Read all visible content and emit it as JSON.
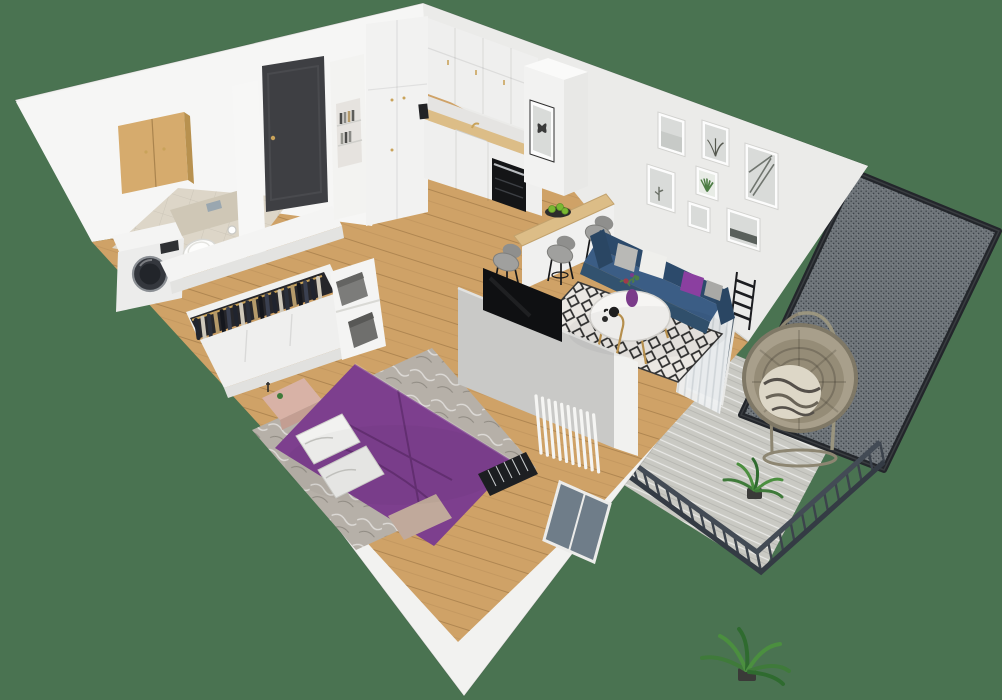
{
  "scene": {
    "kind": "isometric-apartment-render",
    "background_color": "#4a7351"
  },
  "palette": {
    "background": "#4a7351",
    "wall": "#f2f2f0",
    "wall_bright": "#f7f7f6",
    "wall_shade": "#ebebe9",
    "wall_inner_nw": "#f6f6f5",
    "floor_wood": "#cfa267",
    "counter_wood": "#dcbd87",
    "cabinet_wood": "#d6ab6d",
    "tile_floor": "#ddd6c8",
    "tile_halfwall": "#cfc7b6",
    "door_dark": "#3e3f43",
    "cabinet_white": "#efefee",
    "sofa_navy": "#3b5d85",
    "sofa_navy_dark": "#2c4a6b",
    "sofa_navy_front": "#32526f",
    "duvet_purple": "#7d3f8e",
    "pillow_purple": "#8b3fa0",
    "vase_purple": "#7b3b8a",
    "blush_pink": "#d8b2a6",
    "bench_taupe": "#c0a99b",
    "rug_white": "#ebe8e3",
    "rug_marble": "#b6b0a8",
    "tv_black": "#0f1012",
    "radiator_black": "#1d1f22",
    "stool_gray": "#a0a09e",
    "metal_black": "#17181a",
    "gold": "#c9a35a",
    "curtain": "#eef0f1",
    "glass": "#5d6b77",
    "decking": "#c9c9c3",
    "railing": "#3c434c",
    "mesh_frame": "#23262b",
    "rattan": "#a89f8b",
    "rattan_inner": "#958c77",
    "plant_green": "#3f7a3a",
    "plant_green_light": "#4b8f3f",
    "apple_green": "#79b832",
    "washer_drum": "#34373d",
    "box_gray": "#7c7c7a",
    "frame_white": "#fcfcfc",
    "photo_gray": "#d9dbd9",
    "aloe_green": "#4e7d46",
    "oven_black": "#141517",
    "partition_gray": "#c9c9c7",
    "closet_dark": "#26262a"
  },
  "gallery": {
    "frames": [
      {
        "kind": "misty-landscape"
      },
      {
        "kind": "botanical-twigs"
      },
      {
        "kind": "palm-leaves"
      },
      {
        "kind": "desert-cactus"
      },
      {
        "kind": "aloe-plant-green"
      },
      {
        "kind": "pale-mist"
      },
      {
        "kind": "forest-treeline"
      }
    ]
  },
  "apartment": {
    "hallway": {
      "items": [
        "entry-door",
        "storage-cabinet-with-bookshelf-niche"
      ]
    },
    "bathroom": {
      "items": [
        "washing-machine",
        "wall-hung-toilet",
        "wooden-wall-cabinet",
        "toilet-paper-holder"
      ],
      "floor": "beige-tile"
    },
    "kitchen": {
      "items": [
        "tall-cabinets",
        "upper-cabinets",
        "wood-countertop",
        "sink-with-faucet",
        "built-in-oven",
        "coffee-machine",
        "column-with-butterfly-print",
        "breakfast-bar",
        "fruit-plate-green-apples"
      ],
      "stool_count": 3
    },
    "living_room": {
      "items": [
        "navy-sofa",
        "throw-pillows",
        "diamond-pattern-rug",
        "round-coffee-table",
        "purple-vase-with-flowers",
        "black-tea-set",
        "gold-floor-lamp",
        "gallery-wall",
        "white-curtain",
        "wall-radiator",
        "balcony-door"
      ],
      "gallery_frame_count": 7,
      "pillow_colors": [
        "gray",
        "white",
        "purple",
        "light-gray"
      ]
    },
    "bedroom": {
      "items": [
        "double-bed-purple-duvet",
        "white-pillows",
        "blush-headboard-bench",
        "foot-bench",
        "marble-rug",
        "tv-partition-wall",
        "flat-screen-tv",
        "white-slat-screen",
        "radiator",
        "window"
      ]
    },
    "wardrobe": {
      "items": [
        "open-closet-hanging-clothes",
        "sliding-door-wardrobe",
        "cube-shelf",
        "storage-boxes"
      ],
      "hanger_count": 20,
      "box_count": 2
    },
    "balcony": {
      "items": [
        "hanging-egg-chair",
        "striped-throw",
        "potted-fern",
        "privacy-mesh-screen",
        "metal-railing",
        "gray-decking"
      ],
      "fern_count": 2
    }
  }
}
